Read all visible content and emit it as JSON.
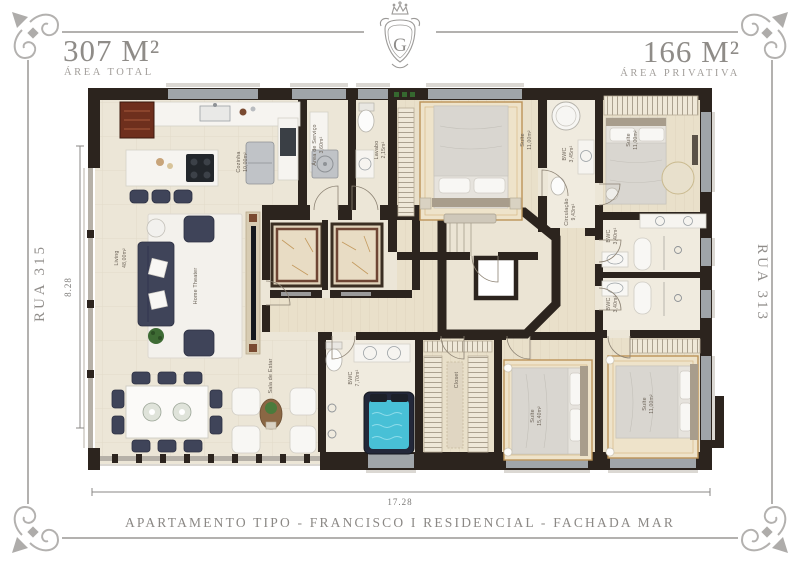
{
  "header": {
    "area_total_value": "307 M²",
    "area_total_label": "ÁREA TOTAL",
    "area_private_value": "166 M²",
    "area_private_label": "ÁREA PRIVATIVA",
    "logo_letter": "G"
  },
  "streets": {
    "left": "RUA 315",
    "right": "RUA 313"
  },
  "dimensions": {
    "height_label": "8.28",
    "width_label": "17.28"
  },
  "footer": {
    "title": "APARTAMENTO TIPO - FRANCISCO I RESIDENCIAL - FACHADA MAR"
  },
  "rooms": [
    {
      "name": "Cozinha",
      "area": "10,00m²"
    },
    {
      "name": "Área de Serviço",
      "area": "3,60m²"
    },
    {
      "name": "Lavabo",
      "area": "2,15m²"
    },
    {
      "name": "Suíte",
      "area": "11,00m²"
    },
    {
      "name": "BWC",
      "area": "3,45m²"
    },
    {
      "name": "Suíte",
      "area": "11,00m²"
    },
    {
      "name": "BWC",
      "area": "3,40m²"
    },
    {
      "name": "BWC",
      "area": "3,40m²"
    },
    {
      "name": "Circulação",
      "area": "9,43m²"
    },
    {
      "name": "Living",
      "area": "48,00m²"
    },
    {
      "name": "Home Theater",
      "area": ""
    },
    {
      "name": "Sala de Estar",
      "area": ""
    },
    {
      "name": "BWC",
      "area": "7,70m²"
    },
    {
      "name": "Closet",
      "area": ""
    },
    {
      "name": "Suíte",
      "area": "15,40m²"
    },
    {
      "name": "Suíte",
      "area": "11,00m²"
    }
  ],
  "colors": {
    "wall": "#2c241e",
    "floor": "#ece6d7",
    "wood": "#e9e0ca",
    "bath": "#f0ebdf",
    "marble": "#f6f4f0",
    "navy": "#3f4459",
    "teal": "#48c0d6",
    "rug": "#bc9358",
    "frame": "#b3b1af",
    "htext": "#8f8c88",
    "ltext": "#6b6257"
  }
}
